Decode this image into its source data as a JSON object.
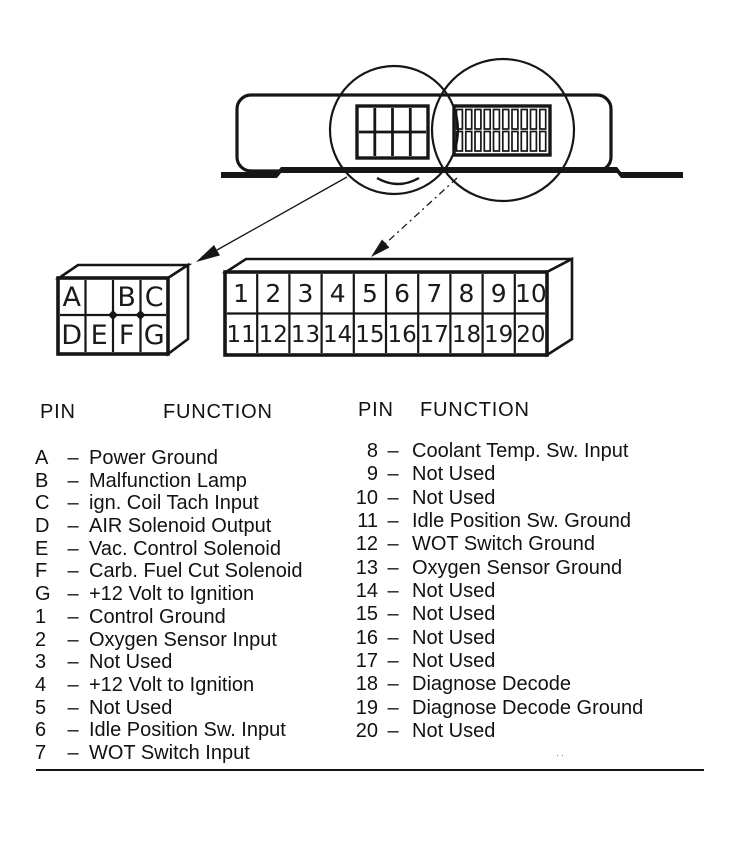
{
  "headers": {
    "pin": "PIN",
    "function": "FUNCTION"
  },
  "separator": "–",
  "connector_small": {
    "cells_top": [
      "A",
      "",
      "B",
      "C"
    ],
    "cells_bottom": [
      "D",
      "E",
      "F",
      "G"
    ]
  },
  "connector_large": {
    "cells_top": [
      "1",
      "2",
      "3",
      "4",
      "5",
      "6",
      "7",
      "8",
      "9",
      "10"
    ],
    "cells_bottom": [
      "11",
      "12",
      "13",
      "14",
      "15",
      "16",
      "17",
      "18",
      "19",
      "20"
    ]
  },
  "pin_functions_left": [
    {
      "pin": "A",
      "function": "Power Ground"
    },
    {
      "pin": "B",
      "function": "Malfunction Lamp"
    },
    {
      "pin": "C",
      "function": "ign. Coil Tach Input"
    },
    {
      "pin": "D",
      "function": "AIR Solenoid Output"
    },
    {
      "pin": "E",
      "function": "Vac. Control Solenoid"
    },
    {
      "pin": "F",
      "function": "Carb. Fuel Cut Solenoid"
    },
    {
      "pin": "G",
      "function": "+12 Volt to Ignition"
    },
    {
      "pin": "1",
      "function": "Control Ground"
    },
    {
      "pin": "2",
      "function": "Oxygen Sensor Input"
    },
    {
      "pin": "3",
      "function": "Not Used"
    },
    {
      "pin": "4",
      "function": "+12 Volt to Ignition"
    },
    {
      "pin": "5",
      "function": "Not Used"
    },
    {
      "pin": "6",
      "function": "Idle Position Sw. Input"
    },
    {
      "pin": "7",
      "function": "WOT Switch Input"
    }
  ],
  "pin_functions_right": [
    {
      "pin": "8",
      "function": "Coolant Temp. Sw. Input"
    },
    {
      "pin": "9",
      "function": "Not Used"
    },
    {
      "pin": "10",
      "function": "Not Used"
    },
    {
      "pin": "11",
      "function": "Idle Position Sw. Ground"
    },
    {
      "pin": "12",
      "function": "WOT Switch Ground"
    },
    {
      "pin": "13",
      "function": "Oxygen Sensor Ground"
    },
    {
      "pin": "14",
      "function": "Not Used"
    },
    {
      "pin": "15",
      "function": "Not Used"
    },
    {
      "pin": "16",
      "function": "Not Used"
    },
    {
      "pin": "17",
      "function": "Not Used"
    },
    {
      "pin": "18",
      "function": "Diagnose Decode"
    },
    {
      "pin": "19",
      "function": "Diagnose Decode Ground"
    },
    {
      "pin": "20",
      "function": "Not Used"
    }
  ],
  "noise_dots": "··"
}
